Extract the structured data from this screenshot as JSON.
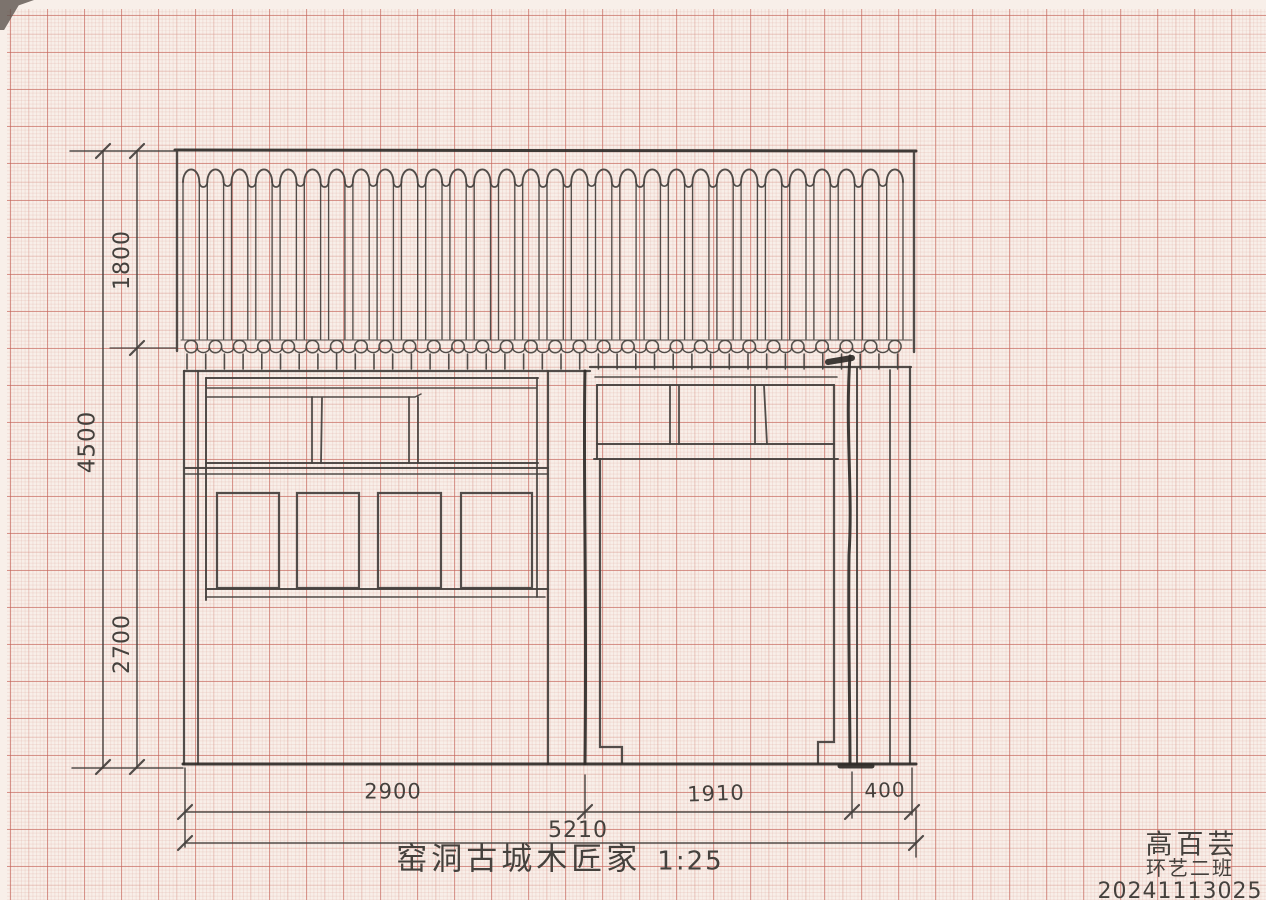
{
  "document": {
    "kind": "hand-drawn architectural elevation sketch on red millimeter graph paper",
    "title": "窑洞古城木匠家",
    "scale_note": "1:25"
  },
  "colors": {
    "paper": "#f8efe9",
    "grid_fine": "rgba(222,168,158,0.22)",
    "grid_medium": "rgba(213,140,128,0.30)",
    "grid_bold": "rgba(196,98,88,0.52)",
    "pencil": "#45413d",
    "pencil_heavy": "#2f2c29"
  },
  "dimensions": {
    "vertical": [
      {
        "id": "roof-band-height",
        "label": "1800"
      },
      {
        "id": "overall-height",
        "label": "4500"
      },
      {
        "id": "lower-wall-height",
        "label": "2700"
      }
    ],
    "horizontal": [
      {
        "id": "left-bay-width",
        "label": "2900"
      },
      {
        "id": "right-bay-width",
        "label": "1910"
      },
      {
        "id": "side-bay-width",
        "label": "400"
      },
      {
        "id": "overall-width",
        "label": "5210"
      }
    ]
  },
  "title_block": {
    "title": "窑洞古城木匠家",
    "scale": "1:25"
  },
  "signature": {
    "name": "高百芸",
    "class_name": "环艺二班",
    "student_id": "20241113025"
  }
}
